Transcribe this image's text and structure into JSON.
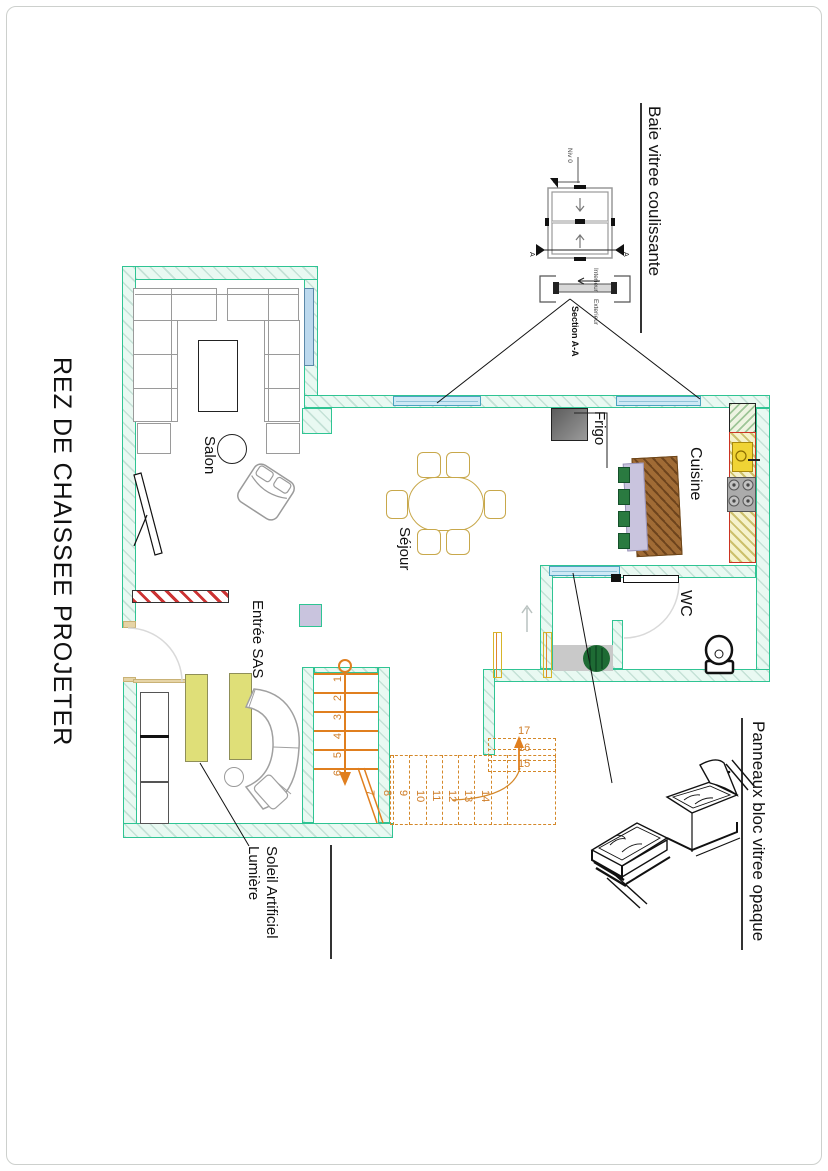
{
  "title": "REZ DE CHAISSEE PROJETER",
  "rooms": {
    "salon": "Salon",
    "sejour": "Séjour",
    "cuisine": "Cuisine",
    "wc": "WC",
    "entree": "Entrée SAS",
    "frigo": "Frigo"
  },
  "annotations": {
    "baie": {
      "label": "Baie vitree coulissante"
    },
    "panneaux": {
      "label": "Panneaux bloc vitree opaque"
    },
    "lumiere": {
      "line1": "Lumière",
      "line2": "Soleil Artificiel"
    },
    "window_detail": {
      "niv": "Niv 0",
      "interieur": "Interieur",
      "exterieur": "Exterieur",
      "section": "Section A-A",
      "cut_marker": "A"
    }
  },
  "stairs": {
    "numbers": [
      "1",
      "2",
      "3",
      "4",
      "5",
      "6",
      "7",
      "8",
      "9",
      "10",
      "11",
      "12",
      "13",
      "14",
      "15",
      "16",
      "17"
    ]
  },
  "colors": {
    "wall_teal": "#2fc493",
    "stair_orange": "#e07f1f",
    "stair_dashed": "#d4882a",
    "window_blue": "#cfe8f5",
    "red_hatch": "#cc3333",
    "counter_yellow": "#f0d435",
    "island_brown": "#a06b35",
    "lavender": "#c9c4de",
    "panel_yellow": "#dfdf78",
    "plant_green": "#1e6b34"
  }
}
